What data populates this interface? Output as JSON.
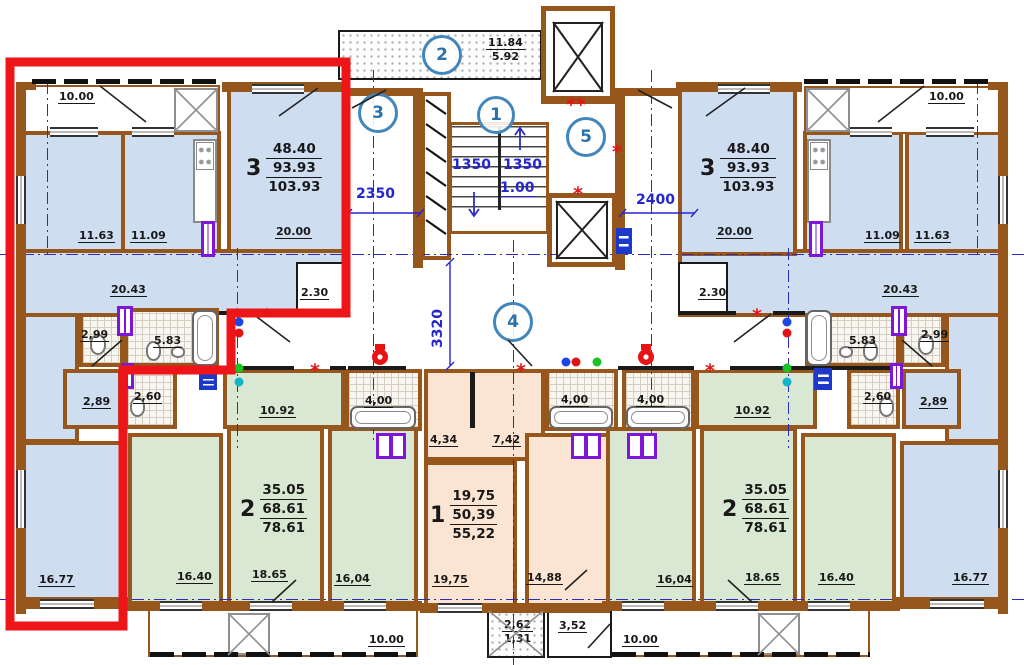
{
  "symbols": {
    "star": "*",
    "double_star": "**"
  },
  "dims": {
    "w2350": "2350",
    "w2400": "2400",
    "h3320": "3320",
    "stair_a": "1350",
    "stair_b": "1350",
    "level": "1.00"
  },
  "core": {
    "sections": {
      "s1": "1",
      "s2": "2",
      "s3": "3",
      "s4": "4",
      "s5": "5"
    },
    "balcony_upper": {
      "a": "11.84",
      "b": "5.92"
    }
  },
  "apartments": {
    "left3": {
      "type": "3",
      "areas": [
        "48.40",
        "93.93",
        "103.93"
      ],
      "living": "20.00",
      "hall": "20.43",
      "bedroom": "11.63",
      "kitchen": "11.09",
      "balcony": "10.00",
      "closet": "2.30",
      "wc": "2,99",
      "bath": "5.83",
      "hall_lower": "2,89",
      "wc_lower": "2,60",
      "bedroom2": "16.77"
    },
    "right3": {
      "type": "3",
      "areas": [
        "48.40",
        "93.93",
        "103.93"
      ],
      "living": "20.00",
      "hall": "20.43",
      "bedroom": "11.63",
      "kitchen": "11.09",
      "balcony": "10.00",
      "closet": "2.30",
      "wc": "2,99",
      "bath": "5.83",
      "hall_lower": "2,89",
      "wc_lower": "2,60",
      "bedroom2": "16.77"
    },
    "left2": {
      "type": "2",
      "areas": [
        "35.05",
        "68.61",
        "78.61"
      ],
      "bedroom": "16.40",
      "living": "18.65",
      "kitchen": "16,04",
      "corridor": "10.92",
      "bath": "4,00"
    },
    "right2": {
      "type": "2",
      "areas": [
        "35.05",
        "68.61",
        "78.61"
      ],
      "bedroom": "16.40",
      "living": "18.65",
      "kitchen": "16,04",
      "corridor": "10.92",
      "bath": "4,00"
    },
    "center1": {
      "type": "1",
      "areas": [
        "19,75",
        "50,39",
        "55,22"
      ],
      "hall_a": "4,34",
      "hall_b": "7,42",
      "room": "19,75",
      "kitchen": "14,88",
      "bath": "4,00",
      "balcony_a": "2,62",
      "balcony_b": "1,31",
      "vestibule": "3,52"
    }
  },
  "bottom": {
    "balcony_left": "10.00",
    "balcony_right": "10.00"
  }
}
